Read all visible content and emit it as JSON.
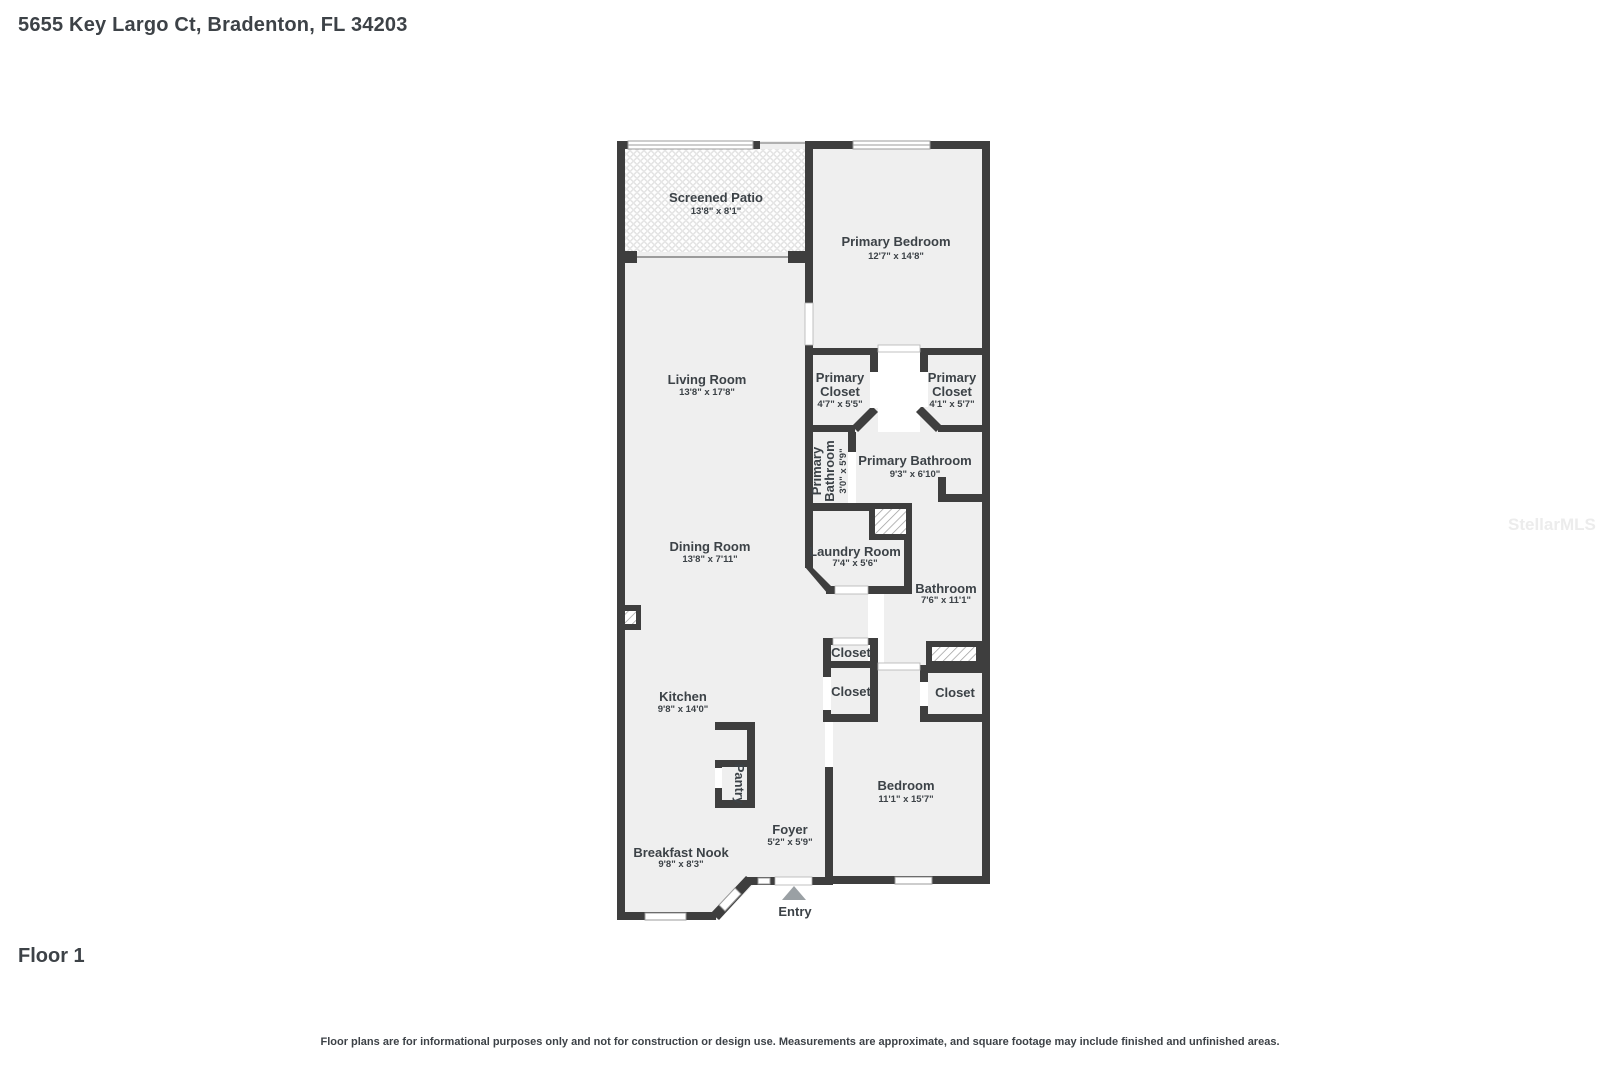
{
  "page": {
    "title": "5655 Key Largo Ct, Bradenton, FL 34203",
    "floor_label": "Floor 1",
    "disclaimer": "Floor plans are for informational purposes only and not for construction or design use. Measurements are approximate, and square footage may include finished and unfinished areas.",
    "watermark": "StellarMLS"
  },
  "colors": {
    "wall": "#3e3e3e",
    "room_fill": "#efefef",
    "label_text": "#3c4247",
    "entry_arrow": "#9aa0a4",
    "hatch_line": "#9a9a9a"
  },
  "rooms": {
    "patio": {
      "name": "Screened Patio",
      "dims": "13'8\" x 8'1\""
    },
    "primary_bedroom": {
      "name": "Primary Bedroom",
      "dims": "12'7\" x 14'8\""
    },
    "living": {
      "name": "Living Room",
      "dims": "13'8\" x 17'8\""
    },
    "pclosetL": {
      "name": "Primary\nCloset",
      "dims": "4'7\" x 5'5\""
    },
    "pclosetR": {
      "name": "Primary\nCloset",
      "dims": "4'1\" x 5'7\""
    },
    "pbath_small": {
      "name": "Primary\nBathroom",
      "dims": "3'0\" x 5'9\""
    },
    "pbath": {
      "name": "Primary Bathroom",
      "dims": "9'3\" x 6'10\""
    },
    "dining": {
      "name": "Dining Room",
      "dims": "13'8\" x 7'11\""
    },
    "laundry": {
      "name": "Laundry Room",
      "dims": "7'4\" x 5'6\""
    },
    "bathroom": {
      "name": "Bathroom",
      "dims": "7'6\" x 11'1\""
    },
    "closet_hall_1": {
      "name": "Closet"
    },
    "closet_hall_2": {
      "name": "Closet"
    },
    "closet_bedroom": {
      "name": "Closet"
    },
    "kitchen": {
      "name": "Kitchen",
      "dims": "9'8\" x 14'0\""
    },
    "pantry": {
      "name": "Pantry"
    },
    "foyer": {
      "name": "Foyer",
      "dims": "5'2\" x 5'9\""
    },
    "nook": {
      "name": "Breakfast Nook",
      "dims": "9'8\" x 8'3\""
    },
    "bedroom": {
      "name": "Bedroom",
      "dims": "11'1\" x 15'7\""
    },
    "entry": {
      "name": "Entry"
    }
  }
}
